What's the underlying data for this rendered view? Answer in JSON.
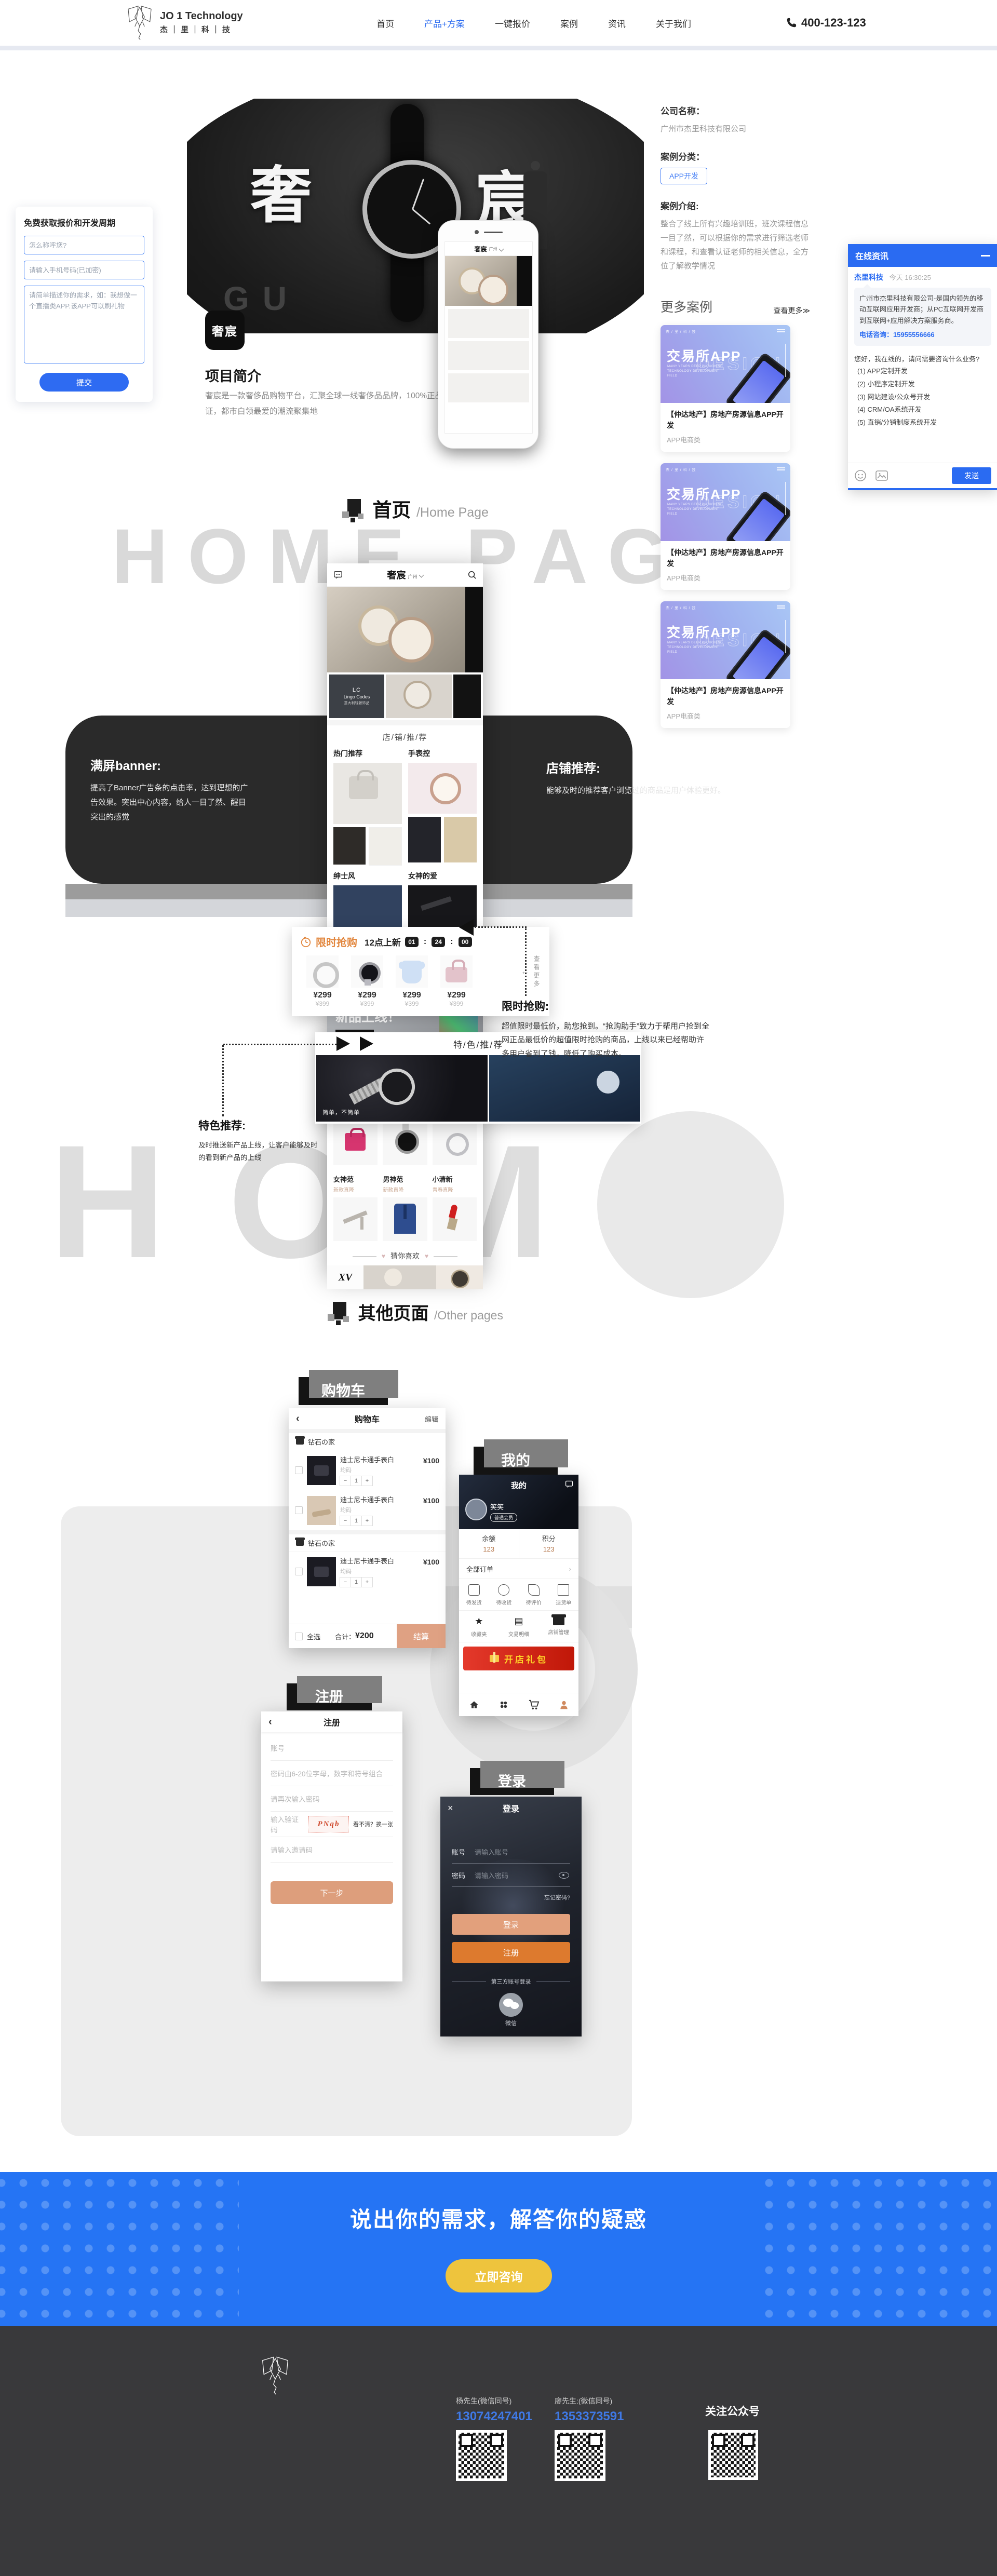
{
  "header": {
    "logo_en": "JO 1 Technology",
    "logo_cn": "杰｜里｜科｜技",
    "nav": [
      {
        "label": "首页"
      },
      {
        "label": "产品+方案"
      },
      {
        "label": "一键报价"
      },
      {
        "label": "案例"
      },
      {
        "label": "资讯"
      },
      {
        "label": "关于我们"
      }
    ],
    "phone": "400-123-123"
  },
  "quote_form": {
    "title": "免费获取报价和开发周期",
    "name_placeholder": "怎么称呼您?",
    "phone_placeholder": "请输入手机号码(已加密)",
    "desc_placeholder": "请简单描述你的需求，如：我想做一个直播类APP.该APP可以刷礼物",
    "submit": "提交"
  },
  "case_info": {
    "company_label": "公司名称：",
    "company": "广州市杰里科技有限公司",
    "category_label": "案例分类：",
    "category": "APP开发",
    "intro_label": "案例介绍:",
    "intro": "整合了线上所有兴趣培训班，班次课程信息一目了然，可以根据你的需求进行筛选老师和课程，和查看认证老师的相关信息，全方位了解教学情况"
  },
  "more_cases": {
    "title": "更多案例",
    "view_more": "查看更多≫",
    "cards": [
      {
        "brand": "杰 / 里 / 科 / 技",
        "big": "交易所APP",
        "lines": "MANY YEARS DEEP PLOUGHING TECHNOLOGY DEVELOPMENT FIELD",
        "design": "DESIGN",
        "title": "【仲达地产】房地产房源信息APP开发",
        "category": "APP电商类"
      },
      {
        "brand": "杰 / 里 / 科 / 技",
        "big": "交易所APP",
        "lines": "MANY YEARS DEEP PLOUGHING TECHNOLOGY DEVELOPMENT FIELD",
        "design": "DESIGN",
        "title": "【仲达地产】房地产房源信息APP开发",
        "category": "APP电商类"
      },
      {
        "brand": "杰 / 里 / 科 / 技",
        "big": "交易所APP",
        "lines": "MANY YEARS DEEP PLOUGHING TECHNOLOGY DEVELOPMENT FIELD",
        "design": "DESIGN",
        "title": "【仲达地产】房地产房源信息APP开发",
        "category": "APP电商类"
      }
    ]
  },
  "chat": {
    "title": "在线资讯",
    "sender": "杰里科技",
    "time": "今天 16:30:25",
    "intro": "广州市杰里科技有限公司-是国内领先的移动互联网应用开发商；从PC互联网开发商到互联网+应用解决方案服务商。",
    "tel_label": "电话咨询：",
    "tel": "15955556666",
    "greeting": "您好，我在线的，请问需要咨询什么业务?",
    "options": [
      {
        "label": "(1) APP定制开发"
      },
      {
        "label": "(2) 小程序定制开发"
      },
      {
        "label": "(3) 网站建设/公众号开发"
      },
      {
        "label": "(4) CRM/OA系统开发"
      },
      {
        "label": "(5) 直销/分销制度系统开发"
      }
    ],
    "send": "发送"
  },
  "banner": {
    "char_left": "奢",
    "char_right": "宸",
    "deco": "GU"
  },
  "intro": {
    "icon_text": "奢宸",
    "title": "项目简介",
    "desc": "奢宸是一款奢侈品购物平台，汇聚全球一线奢侈品品牌，100%正品保证，都市白领最爱的潮流聚集地"
  },
  "sections": {
    "home_title": "首页",
    "home_sub": "/Home Page",
    "home_bg": "HOME PAGE",
    "other_title": "其他页面",
    "other_sub": "/Other pages",
    "other_bg": "HOME"
  },
  "app_home": {
    "brand": "奢宸",
    "city": "广州",
    "brand_tile_a": "LC",
    "brand_tile_b": "Lingo Codes",
    "brand_tile_c": "意大利轻奢饰品",
    "shop_header": "店/铺/推/荐",
    "sec1": "热门推荐",
    "sec2": "手表控",
    "sec3": "绅士风",
    "sec4": "女神的爱",
    "fashion_tag": "时尚穿搭",
    "fashion_title": "新品上线！",
    "fashion_btn": "点击查看 >>",
    "feature_header": "特/色/推/荐",
    "feature_caption": "简单，不简单",
    "cats": [
      {
        "n": "白富美",
        "s": "时尚直降"
      },
      {
        "n": "手表控",
        "s": "手表直降"
      },
      {
        "n": "谈恋爱",
        "s": "成双直降"
      },
      {
        "n": "女神范",
        "s": "新款直降"
      },
      {
        "n": "男神范",
        "s": "新款直降"
      },
      {
        "n": "小清新",
        "s": "青春直降"
      }
    ],
    "guess": "猜你喜欢",
    "guess_heart": "♥",
    "guess_logo": "XV"
  },
  "flash": {
    "title": "限时抢购",
    "sub": "12点上新",
    "c1": "01",
    "c2": "24",
    "c3": "00",
    "colon": ":",
    "price": "¥299",
    "old_price": "¥399",
    "more": "查看更多",
    "arrow": "←"
  },
  "annotations": {
    "banner_title": "满屏banner:",
    "banner_text": "提高了Banner广告条的点击率，达到理想的广告效果。突出中心内容，给人一目了然、醒目突出的感觉",
    "shop_title": "店铺推荐:",
    "shop_text": "能够及时的推荐客户浏览过的商品是用户体验更好。",
    "flash_title": "限时抢购:",
    "flash_text": "超值限时最低价，助您抢到。“抢购助手”致力于帮用户抢到全网正品最低价的超值限时抢购的商品，上线以来已经帮助许多用户省到了钱，降低了购买成本。",
    "feature_title": "特色推荐:",
    "feature_text": "及时推送新产品上线，让客户能够及时的看到新产品的上线"
  },
  "cart_screen": {
    "label": "购物车",
    "back": "‹",
    "title": "购物车",
    "edit": "编辑",
    "store": "钻石の家",
    "item_name": "迪士尼卡通手表白",
    "item_size": "均码",
    "minus": "−",
    "qty": "1",
    "plus": "+",
    "item_price": "¥100",
    "select_all": "全选",
    "total_label": "合计：",
    "total": "¥200",
    "checkout": "结算"
  },
  "profile_screen": {
    "label": "我的",
    "title": "我的",
    "name": "笑笑",
    "badge": "普通会员",
    "balance_label": "余额",
    "balance": "123",
    "points_label": "积分",
    "points": "123",
    "orders": "全部订单",
    "orders_arrow": "›",
    "order_icons": [
      {
        "label": "待发货"
      },
      {
        "label": "待收货"
      },
      {
        "label": "待评价"
      },
      {
        "label": "退货单"
      }
    ],
    "tool_icons": [
      {
        "label": "收藏夹",
        "glyph": "★"
      },
      {
        "label": "交易明细",
        "glyph": "▤"
      },
      {
        "label": "店铺管理",
        "glyph": ""
      }
    ],
    "gift": "开店礼包"
  },
  "register_screen": {
    "label": "注册",
    "back": "‹",
    "title": "注册",
    "f1": "账号",
    "f2": "密码由6-20位字母，数字和符号组合",
    "f3": "请再次输入密码",
    "f4": "输入验证码",
    "captcha": "PNqb",
    "captcha_hint": "看不清？换一张",
    "f5": "请输入邀请码",
    "next": "下一步"
  },
  "login_screen": {
    "label": "登录",
    "close": "×",
    "title": "登录",
    "account_label": "账号",
    "account_placeholder": "请输入账号",
    "pwd_label": "密码",
    "pwd_placeholder": "请输入密码",
    "forgot": "忘记密码?",
    "login_btn": "登录",
    "register_btn": "注册",
    "third": "第三方账号登录",
    "wechat": "微信"
  },
  "cta": {
    "title": "说出你的需求，解答你的疑惑",
    "button": "立即咨询"
  },
  "footer": {
    "logo_cn": "杰｜里｜科｜技",
    "logo_en": "JO 1 Technology",
    "company": "广东杰里科技有限公司",
    "tel": "联系电话：020-8928-1215",
    "address": "公司地址：天河区39-49号中旅商务大厦东塔25AF",
    "hotline": "咨询热线",
    "contact1_name": "杨先生(微信同号)",
    "contact1_num": "13074247401",
    "contact2_name": "廖先生:(微信同号)",
    "contact2_num": "1353373591",
    "follow": "关注公众号",
    "icp": "粤ICP备20059313号-1",
    "copyright": "COPYRIGHT 2016 JOONEIT ALL RIGHTS RESERVED"
  }
}
